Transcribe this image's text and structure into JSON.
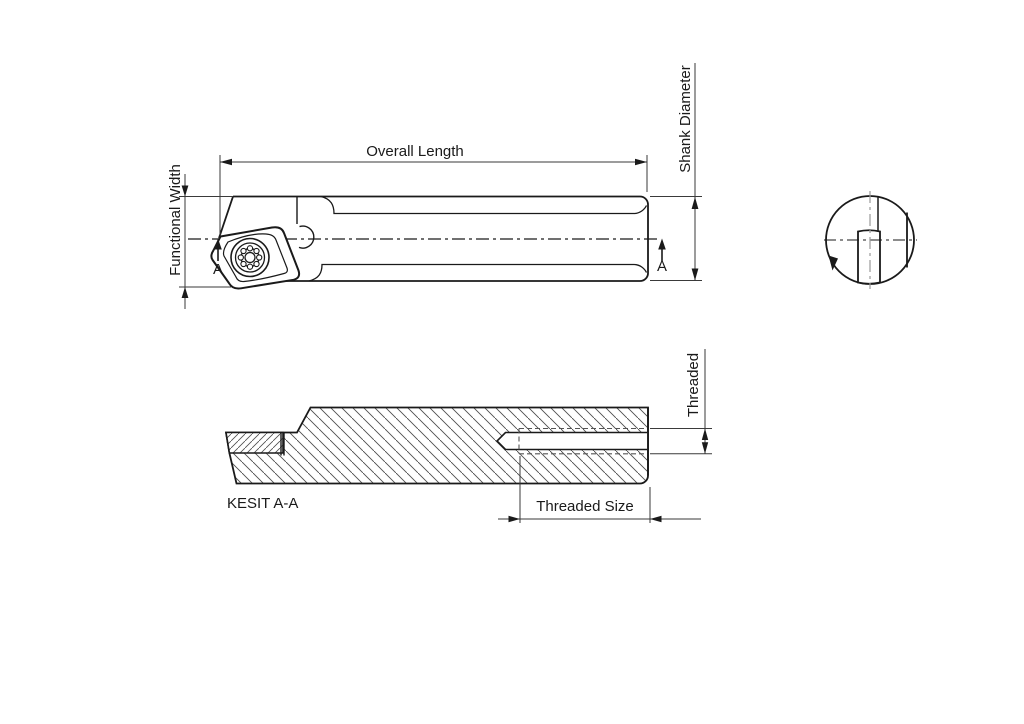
{
  "page": {
    "background": "#ffffff"
  },
  "labels": {
    "overall_length": "Overall Length",
    "functional_width": "Functional Width",
    "shank_diameter": "Shank Diameter",
    "threaded": "Threaded",
    "threaded_size": "Threaded Size",
    "section_title": "KESIT A-A",
    "section_marker_left": "A",
    "section_marker_right": "A"
  },
  "colors": {
    "line": "#1a1a1a",
    "dimension": "#3a3a3a",
    "hatch": "#4d4d4d",
    "hidden_dash": "#555555",
    "gray_centerline": "#999999"
  }
}
